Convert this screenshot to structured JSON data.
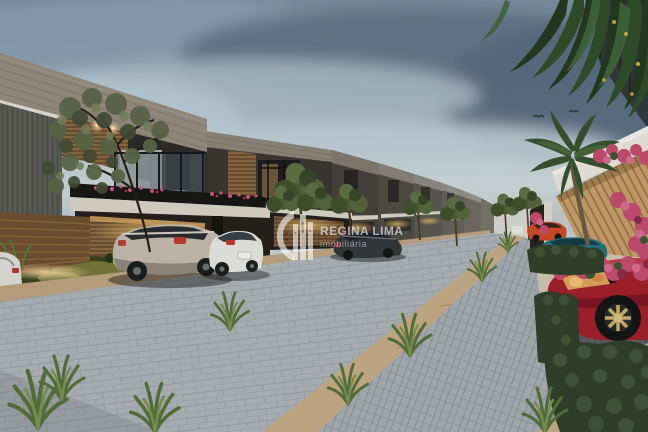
{
  "watermark": {
    "brand": "REGINA LIMA",
    "tagline": "imobiliária",
    "logo_icon": "buildings-crescent-logo-icon",
    "text_color": "#FFFFFF"
  },
  "scene": {
    "type": "architectural-render-photo",
    "setting": "modern townhouse condominium street at dusk",
    "elements": [
      "row-of-modern-townhouses",
      "interlocking-paver-street",
      "paver-sidewalk",
      "parked-champagne-suv",
      "parked-white-hatchback",
      "parked-dark-suv",
      "parked-red-suv",
      "parked-teal-sedan",
      "parked-orange-car",
      "palm-tree",
      "hanging-palm-fronds",
      "bougainvillea-flowers",
      "hedges",
      "street-trees",
      "grass-tufts",
      "dusk-cloudy-sky",
      "birds"
    ]
  },
  "colors": {
    "sky_top": "#7c8fa3",
    "sky_horizon": "#d7dcdb",
    "cloud_dark": "#5d7084",
    "street_paver": "#b8bcc1",
    "sidewalk_paver": "#a6acb3",
    "curb_sand": "#c6ab85",
    "house_stone": "#93897c",
    "house_charcoal": "#2c2a27",
    "wood_slat": "#7d5c3b",
    "warm_light": "#f5c97a",
    "foliage_dark": "#31402a",
    "bougainvillea_pink": "#c64a70",
    "car_red": "#a31e2c",
    "car_teal": "#227381",
    "car_orange": "#cf4a24",
    "car_champagne": "#c3bbac",
    "car_white": "#e6e6e3"
  }
}
